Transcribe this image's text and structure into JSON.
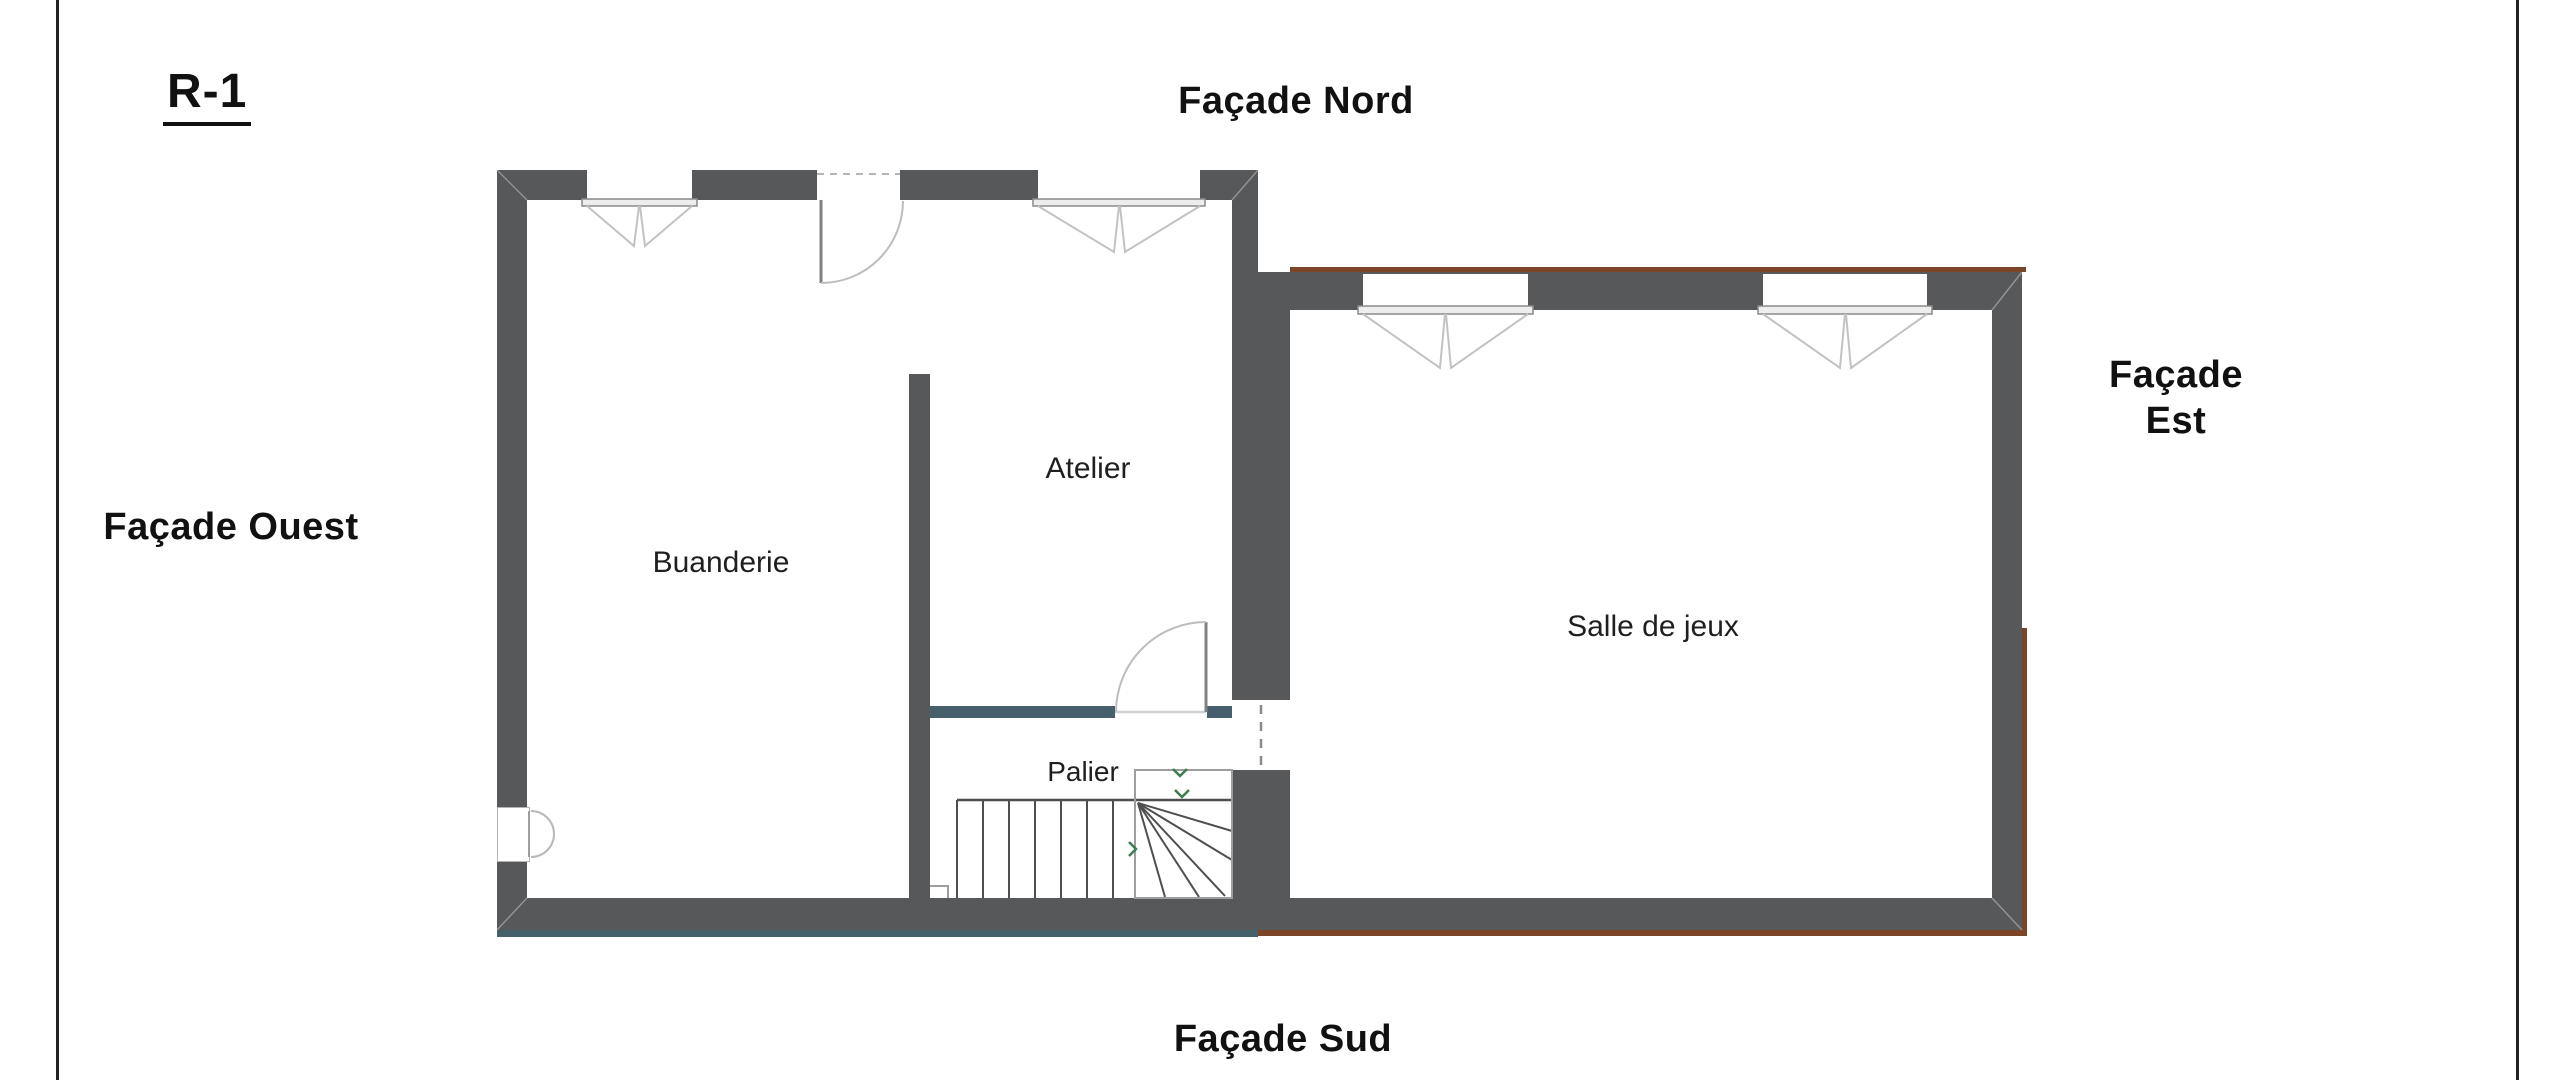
{
  "page": {
    "floor_label": "R-1"
  },
  "facades": {
    "north": "Façade Nord",
    "south": "Façade Sud",
    "west": "Façade Ouest",
    "east_line1": "Façade",
    "east_line2": "Est"
  },
  "rooms": {
    "buanderie": "Buanderie",
    "atelier": "Atelier",
    "palier": "Palier",
    "salle_de_jeux": "Salle de jeux"
  },
  "colors": {
    "wall": "#57585a",
    "slate": "#46606b",
    "brown": "#7c4527",
    "green": "#3e7c52",
    "border": "#222222",
    "text": "#1c1c1c"
  }
}
